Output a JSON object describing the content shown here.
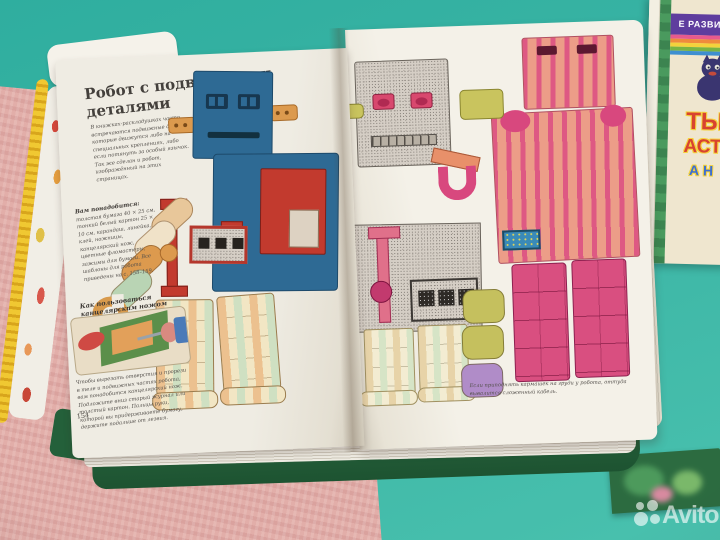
{
  "watermark": {
    "brand": "Avito"
  },
  "left_page": {
    "title": "Робот с подвижными деталями",
    "intro": "В книжках-раскладушках часто встречаются подвижные детали, которые движутся либо на специальных креплениях, либо если потянуть за особый язычок. Так же сделан и робот, изображённый на этих страницах.",
    "materials_heading": "Вам понадобится:",
    "materials": "толстая бумага 40 × 25 см, тонкий белый картон 25 × 10 см, карандаш, линейка, клей, ножницы, канцелярский нож, цветные фломастеры, зажимы для бумаги. Все шаблоны для робота приведены на с. 158–159.",
    "howto_heading": "Как пользоваться канцелярским ножом",
    "howto_text": "Чтобы вырезать отверстия и прорези в теле и подвижных частях робота, вам понадобится канцелярский нож. Подложите вниз старый журнал или толстый картон. Пальцы руки, которой вы придерживаете бумагу, держите подальше от лезвия.",
    "page_number": "154"
  },
  "right_page": {
    "caption": "Если приподнять кармашек на груди у робота, оттуда вывалится сложенный кабель."
  },
  "background_book": {
    "band_text": "Е РАЗВИТ",
    "title_fragments": [
      "ТЫ",
      "АСТ",
      "А Н"
    ]
  },
  "colors": {
    "table_teal": "#3db6a6",
    "blanket_pink": "#e2aea9",
    "blue_robot": "#2e6a94",
    "pink_robot": "#d94f80",
    "book_page": "#efece3"
  }
}
